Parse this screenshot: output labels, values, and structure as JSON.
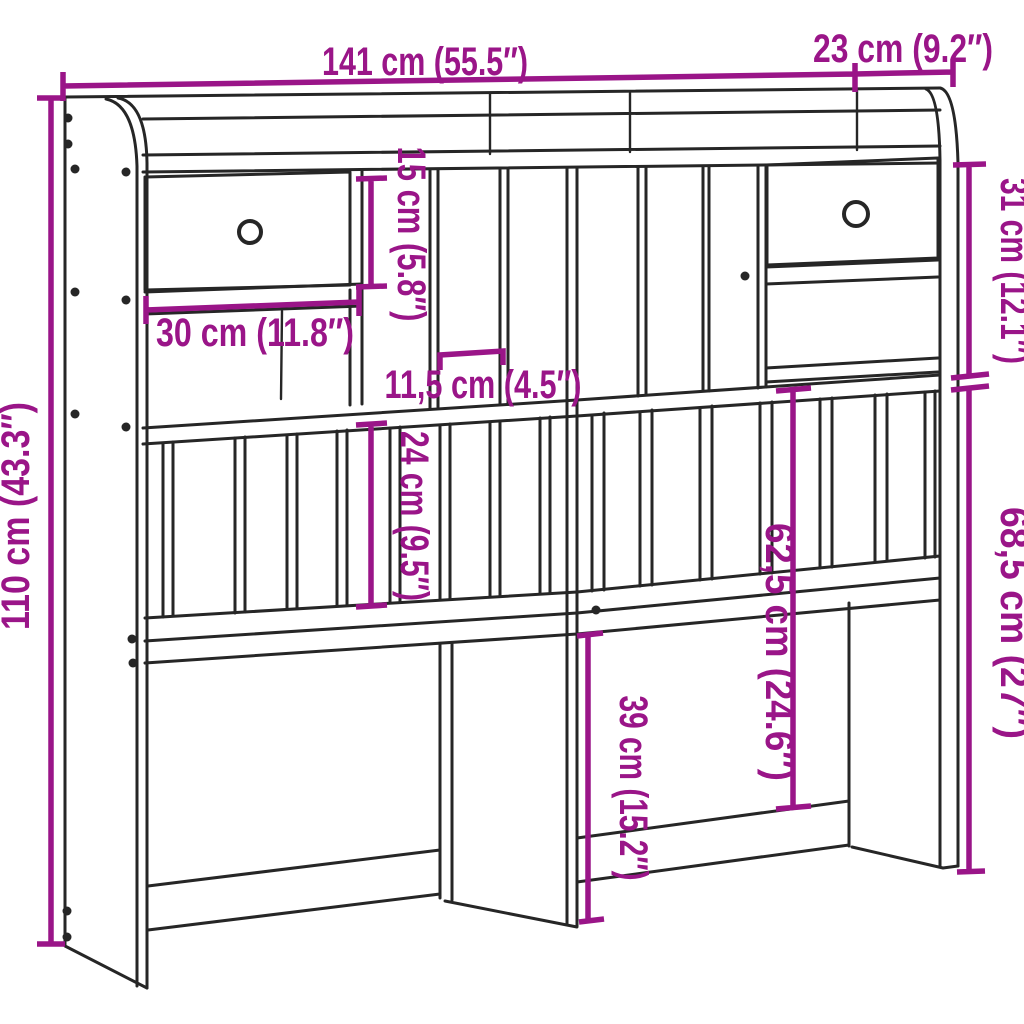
{
  "style": {
    "background": "#ffffff",
    "line_color": "#262626",
    "dimension_color": "#9a1588"
  },
  "dimensions": {
    "total_width": "141 cm (55.5″)",
    "top_section_depth": "23 cm (9.2″)",
    "total_height": "110 cm (43.3″)",
    "top_section_height": "31 cm (12.1″)",
    "lower_section_height": "68,5 cm (27″)",
    "shelf_opening_height": "15 cm (5.8″)",
    "drawer_opening_width": "30 cm (11.8″)",
    "cubby_width": "11,5 cm (4.5″)",
    "slat_section_height": "24 cm (9.5″)",
    "headboard_panel_height": "62,5 cm (24.6″)",
    "leg_clearance_height": "39 cm (15.2″)"
  }
}
